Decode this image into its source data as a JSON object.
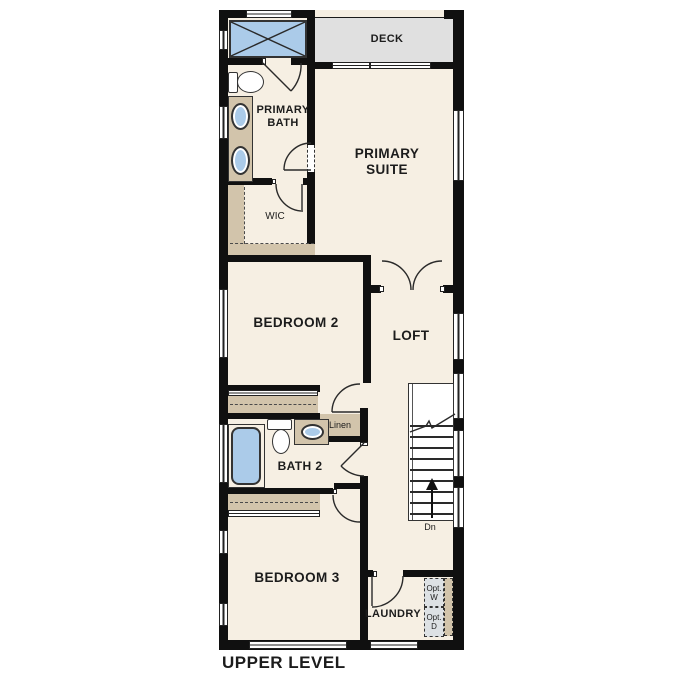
{
  "plan": {
    "title": "UPPER LEVEL",
    "rooms": {
      "deck": "DECK",
      "primary_bath": "PRIMARY\nBATH",
      "primary_suite": "PRIMARY\nSUITE",
      "wic": "WIC",
      "bedroom2": "BEDROOM 2",
      "loft": "LOFT",
      "bath2": "BATH 2",
      "linen": "Linen",
      "bedroom3": "BEDROOM 3",
      "laundry": "LAUNDRY"
    },
    "annotations": {
      "stairs_direction": "Dn",
      "optional_washer": "Opt.\nW",
      "optional_dryer": "Opt.\nD"
    },
    "colors": {
      "floor": "#f6efe3",
      "wall": "#101010",
      "tan": "#d2c4ab",
      "blue": "#abcbe9",
      "deck": "#e0e0e0",
      "appl": "#dde1e4"
    }
  }
}
